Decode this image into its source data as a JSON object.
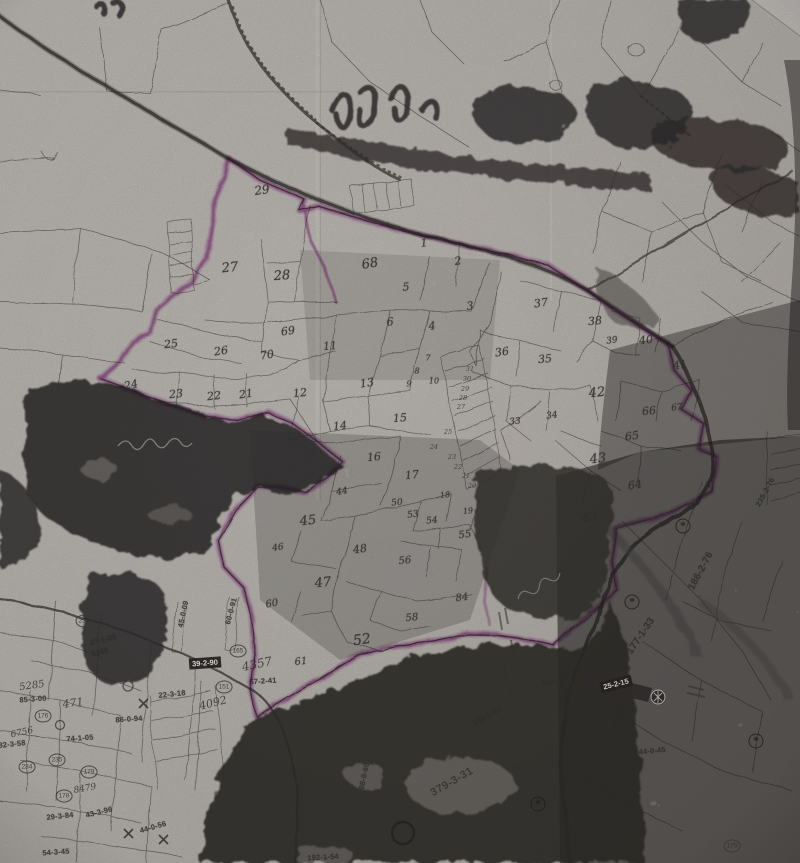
{
  "colors": {
    "paper": "#d2cfc8",
    "paper-light": "#dcd9d3",
    "ink": "#3b3734",
    "toner": "#1f1d1c",
    "gray-texture": "#6a6560",
    "highlight": "#b257ae"
  },
  "map": {
    "parcel_numbers": [
      {
        "text": "29",
        "x": 262,
        "y": 190,
        "size": 12,
        "rot": -8
      },
      {
        "text": "27",
        "x": 230,
        "y": 268,
        "size": 13,
        "rot": -6
      },
      {
        "text": "28",
        "x": 282,
        "y": 276,
        "size": 13,
        "rot": -4
      },
      {
        "text": "68",
        "x": 370,
        "y": 264,
        "size": 13,
        "rot": -10
      },
      {
        "text": "1",
        "x": 424,
        "y": 243,
        "rot": -6
      },
      {
        "text": "2",
        "x": 458,
        "y": 261,
        "rot": -8
      },
      {
        "text": "5",
        "x": 406,
        "y": 287,
        "rot": -4
      },
      {
        "text": "3",
        "x": 470,
        "y": 306,
        "rot": -6
      },
      {
        "text": "4",
        "x": 432,
        "y": 326,
        "rot": -5
      },
      {
        "text": "6",
        "x": 390,
        "y": 322,
        "rot": -5
      },
      {
        "text": "69",
        "x": 288,
        "y": 331,
        "rot": -8
      },
      {
        "text": "11",
        "x": 330,
        "y": 346,
        "rot": -5
      },
      {
        "text": "7",
        "x": 428,
        "y": 358,
        "size": 8
      },
      {
        "text": "8",
        "x": 417,
        "y": 371,
        "size": 8
      },
      {
        "text": "9",
        "x": 409,
        "y": 384,
        "size": 8
      },
      {
        "text": "10",
        "x": 434,
        "y": 381,
        "size": 8
      },
      {
        "text": "25",
        "x": 171,
        "y": 344,
        "rot": -6
      },
      {
        "text": "26",
        "x": 221,
        "y": 351,
        "rot": -8
      },
      {
        "text": "70",
        "x": 267,
        "y": 355,
        "rot": -10
      },
      {
        "text": "24",
        "x": 131,
        "y": 385,
        "rot": -12
      },
      {
        "text": "23",
        "x": 176,
        "y": 394,
        "rot": -6
      },
      {
        "text": "22",
        "x": 214,
        "y": 396,
        "rot": -6
      },
      {
        "text": "21",
        "x": 246,
        "y": 394,
        "rot": -8
      },
      {
        "text": "12",
        "x": 300,
        "y": 393,
        "rot": -6
      },
      {
        "text": "13",
        "x": 367,
        "y": 383,
        "rot": -8
      },
      {
        "text": "14",
        "x": 340,
        "y": 426,
        "rot": -6
      },
      {
        "text": "15",
        "x": 400,
        "y": 418,
        "rot": -4
      },
      {
        "text": "16",
        "x": 374,
        "y": 457,
        "rot": -5
      },
      {
        "text": "17",
        "x": 412,
        "y": 475,
        "rot": -6
      },
      {
        "text": "18",
        "x": 445,
        "y": 495,
        "size": 8,
        "rot": -6
      },
      {
        "text": "19",
        "x": 468,
        "y": 511,
        "size": 8,
        "rot": -6
      },
      {
        "text": "37",
        "x": 541,
        "y": 303,
        "rot": -8
      },
      {
        "text": "38",
        "x": 595,
        "y": 321,
        "rot": -6
      },
      {
        "text": "39",
        "x": 612,
        "y": 341,
        "size": 9,
        "rot": -8
      },
      {
        "text": "40",
        "x": 646,
        "y": 340,
        "rot": -6
      },
      {
        "text": "36",
        "x": 502,
        "y": 352,
        "rot": -8
      },
      {
        "text": "35",
        "x": 545,
        "y": 359,
        "rot": -5
      },
      {
        "text": "41",
        "x": 680,
        "y": 365,
        "rot": -10
      },
      {
        "text": "42",
        "x": 597,
        "y": 393,
        "size": 13,
        "rot": -6
      },
      {
        "text": "66",
        "x": 649,
        "y": 411,
        "rot": -6
      },
      {
        "text": "67",
        "x": 677,
        "y": 408,
        "size": 9,
        "rot": -8
      },
      {
        "text": "33",
        "x": 515,
        "y": 422,
        "size": 9,
        "rot": -6
      },
      {
        "text": "34",
        "x": 552,
        "y": 416,
        "size": 9,
        "rot": -8
      },
      {
        "text": "65",
        "x": 632,
        "y": 436,
        "rot": -8
      },
      {
        "text": "43",
        "x": 598,
        "y": 459,
        "size": 13,
        "rot": -6
      },
      {
        "text": "64",
        "x": 635,
        "y": 485,
        "rot": -8
      },
      {
        "text": "63",
        "x": 590,
        "y": 517,
        "rot": -6
      },
      {
        "text": "44",
        "x": 342,
        "y": 492,
        "size": 9,
        "rot": -10
      },
      {
        "text": "45",
        "x": 308,
        "y": 521,
        "size": 13,
        "rot": -6
      },
      {
        "text": "46",
        "x": 278,
        "y": 548,
        "size": 9,
        "rot": -8
      },
      {
        "text": "47",
        "x": 323,
        "y": 583,
        "size": 13,
        "rot": -6
      },
      {
        "text": "48",
        "x": 360,
        "y": 549,
        "size": 11,
        "rot": -8
      },
      {
        "text": "50",
        "x": 397,
        "y": 503,
        "size": 9,
        "rot": -6
      },
      {
        "text": "53",
        "x": 413,
        "y": 515,
        "size": 9,
        "rot": -8
      },
      {
        "text": "54",
        "x": 432,
        "y": 521,
        "size": 9,
        "rot": -6
      },
      {
        "text": "55",
        "x": 465,
        "y": 535,
        "size": 10,
        "rot": -8
      },
      {
        "text": "56",
        "x": 405,
        "y": 561,
        "size": 10,
        "rot": -6
      },
      {
        "text": "84",
        "x": 462,
        "y": 598,
        "size": 10,
        "rot": -8
      },
      {
        "text": "58",
        "x": 412,
        "y": 618,
        "size": 10,
        "rot": -6
      },
      {
        "text": "52",
        "x": 362,
        "y": 640,
        "size": 14,
        "rot": -8
      },
      {
        "text": "60",
        "x": 272,
        "y": 604,
        "size": 10,
        "rot": -10
      },
      {
        "text": "61",
        "x": 301,
        "y": 662,
        "size": 10,
        "rot": -6
      },
      {
        "text": "31",
        "x": 470,
        "y": 369,
        "kind": "tiny"
      },
      {
        "text": "30",
        "x": 467,
        "y": 379,
        "kind": "tiny"
      },
      {
        "text": "29",
        "x": 465,
        "y": 389,
        "kind": "tiny"
      },
      {
        "text": "28",
        "x": 463,
        "y": 398,
        "kind": "tiny"
      },
      {
        "text": "27",
        "x": 461,
        "y": 407,
        "kind": "tiny"
      },
      {
        "text": "25",
        "x": 448,
        "y": 432,
        "kind": "tiny"
      },
      {
        "text": "24",
        "x": 434,
        "y": 447,
        "kind": "tiny"
      },
      {
        "text": "23",
        "x": 452,
        "y": 457,
        "kind": "tiny"
      },
      {
        "text": "22",
        "x": 458,
        "y": 467,
        "kind": "tiny"
      },
      {
        "text": "21",
        "x": 466,
        "y": 476,
        "kind": "tiny"
      },
      {
        "text": "20",
        "x": 472,
        "y": 486,
        "kind": "tiny"
      }
    ],
    "area_labels": [
      {
        "text": "47-1-83",
        "x": 103,
        "y": 640,
        "rot": -15
      },
      {
        "text": "5346",
        "x": 100,
        "y": 652,
        "rot": -15
      },
      {
        "text": "5285",
        "x": 32,
        "y": 686,
        "kind": "hand",
        "size": 10,
        "rot": -8
      },
      {
        "text": "85-3-00",
        "x": 33,
        "y": 699,
        "rot": -4
      },
      {
        "text": "471",
        "x": 73,
        "y": 703,
        "kind": "hand",
        "size": 11,
        "rot": -8
      },
      {
        "text": "6756",
        "x": 22,
        "y": 733,
        "kind": "hand",
        "size": 9,
        "rot": -12
      },
      {
        "text": "82-3-58",
        "x": 12,
        "y": 744,
        "rot": -6
      },
      {
        "text": "74-1-05",
        "x": 80,
        "y": 738,
        "rot": -4
      },
      {
        "text": "86-0-94",
        "x": 129,
        "y": 719,
        "rot": -4
      },
      {
        "text": "22-3-18",
        "x": 172,
        "y": 694,
        "rot": -6
      },
      {
        "text": "39-2-90",
        "x": 205,
        "y": 663,
        "kind": "inverted",
        "rot": -4
      },
      {
        "text": "45-0-09",
        "x": 183,
        "y": 614,
        "rot": -78
      },
      {
        "text": "60-0-91",
        "x": 231,
        "y": 611,
        "rot": -75
      },
      {
        "text": "4357",
        "x": 257,
        "y": 664,
        "kind": "hand",
        "size": 12,
        "rot": -12
      },
      {
        "text": "57-2-41",
        "x": 263,
        "y": 681,
        "rot": -4
      },
      {
        "text": "4092",
        "x": 213,
        "y": 703,
        "kind": "hand",
        "size": 11,
        "rot": -14
      },
      {
        "text": "29-3-84",
        "x": 60,
        "y": 816,
        "rot": -6
      },
      {
        "text": "43-3-96",
        "x": 99,
        "y": 812,
        "rot": -14
      },
      {
        "text": "44-0-56",
        "x": 153,
        "y": 827,
        "rot": -16
      },
      {
        "text": "54-3-45",
        "x": 56,
        "y": 852,
        "rot": -4
      },
      {
        "text": "8479",
        "x": 85,
        "y": 789,
        "kind": "hand",
        "size": 9,
        "rot": -10
      },
      {
        "text": "192-1-54",
        "x": 323,
        "y": 857,
        "rot": -3
      },
      {
        "text": "177-1-33",
        "x": 641,
        "y": 636,
        "size": 10,
        "rot": -56
      },
      {
        "text": "186-2-76",
        "x": 701,
        "y": 571,
        "size": 10,
        "rot": -62
      },
      {
        "text": "235-2-76",
        "x": 765,
        "y": 492,
        "rot": -62
      },
      {
        "text": "107-1-91",
        "x": 557,
        "y": 682,
        "rot": -4
      },
      {
        "text": "142-1-23",
        "x": 487,
        "y": 716,
        "rot": -28
      },
      {
        "text": "25-2-15",
        "x": 616,
        "y": 684,
        "kind": "inverted",
        "rot": -14
      },
      {
        "text": "244-0-45",
        "x": 650,
        "y": 751,
        "rot": -6
      },
      {
        "text": "291-0-43",
        "x": 587,
        "y": 816,
        "rot": -4
      },
      {
        "text": "379-3-31",
        "x": 452,
        "y": 782,
        "kind": "bigarea",
        "rot": -30
      },
      {
        "text": "98-0-60",
        "x": 364,
        "y": 776,
        "rot": -78
      }
    ],
    "circled_numbers": [
      {
        "text": "237",
        "x": 84,
        "y": 621
      },
      {
        "text": "165",
        "x": 238,
        "y": 651
      },
      {
        "text": "151",
        "x": 224,
        "y": 687
      },
      {
        "text": "176",
        "x": 43,
        "y": 716
      },
      {
        "text": "234",
        "x": 27,
        "y": 767
      },
      {
        "text": "235",
        "x": 57,
        "y": 760
      },
      {
        "text": "179",
        "x": 89,
        "y": 772
      },
      {
        "text": "178",
        "x": 64,
        "y": 796
      },
      {
        "text": "175",
        "x": 732,
        "y": 846
      }
    ],
    "symbols": [
      {
        "name": "tree-symbol",
        "glyph": "*",
        "x": 683,
        "y": 526
      },
      {
        "name": "tree-symbol",
        "glyph": "*",
        "x": 632,
        "y": 602
      },
      {
        "name": "tree-symbol",
        "glyph": "*",
        "x": 756,
        "y": 741
      },
      {
        "name": "tree-symbol",
        "glyph": "*",
        "x": 538,
        "y": 804
      }
    ]
  }
}
